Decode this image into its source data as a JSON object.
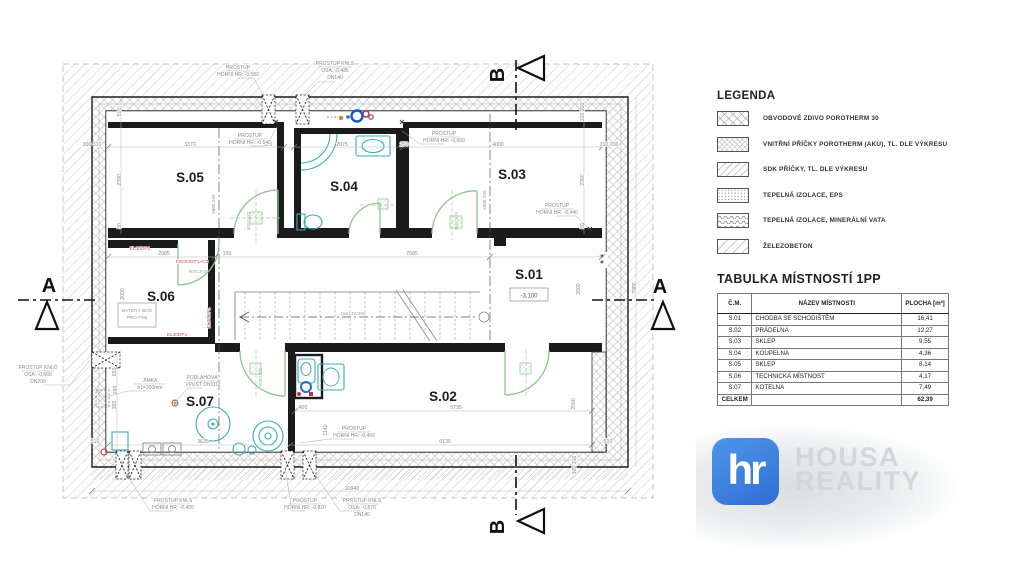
{
  "plan": {
    "section_a": "A",
    "section_b": "B",
    "level_tag": "-3,100",
    "stair_label": "18x172/300",
    "column_label": "HEB 240",
    "rooms": [
      {
        "label": "S.05"
      },
      {
        "label": "S.04"
      },
      {
        "label": "S.03"
      },
      {
        "label": "S.01"
      },
      {
        "label": "S.06"
      },
      {
        "label": "S.07"
      },
      {
        "label": "S.02"
      }
    ],
    "battery_box": {
      "l1": "BATERY BOX",
      "l2": "PRO FVE"
    },
    "red_notes": [
      "EL30DP1",
      "EW30/DP1+C3",
      "EL30DP1",
      "EL30DP1"
    ],
    "door_labels": [
      "800/1970",
      "800/1970",
      "900/1970",
      "800/1970"
    ],
    "annotations": [
      {
        "l1": "PROSTUP",
        "l2": "HORNÍ HR: -0,580"
      },
      {
        "l1": "PROSTUP KNLS",
        "l2": "OSA: -0,485",
        "l3": "DN140"
      },
      {
        "l1": "PROSTUP",
        "l2": "HORNÍ HR: -0,540"
      },
      {
        "l1": "PROSTUP",
        "l2": "HORNÍ HR: -0,500"
      },
      {
        "l1": "PROSTUP",
        "l2": "HORNÍ HR: -0,440"
      },
      {
        "l1": "PROSTUP KNLO",
        "l2": "OSA: -0,660",
        "l3": "DN200"
      },
      {
        "l1": "PROSTUP KNLS",
        "l2": "HORNÍ HR: -0,400"
      },
      {
        "l1": "PROSTUP",
        "l2": "HORNÍ HR: -0,820"
      },
      {
        "l1": "PROSTUP KNLS",
        "l2": "OSA: -0,870",
        "l3": "DN140"
      },
      {
        "l1": "PROSTUP",
        "l2": "HORNÍ HR: -0,450"
      },
      {
        "l1": "JÍMKA",
        "l2": "h1=300mm"
      },
      {
        "l1": "PODLAHOVÁ",
        "l2": "VPUSŤ DN110"
      }
    ],
    "dims": [
      "3370",
      "150",
      "2075",
      "4000",
      "310 200",
      "510",
      "2390",
      "50",
      "310 200",
      "2360",
      "50",
      "7685",
      "2085",
      "150",
      "2000",
      "2000",
      "7880",
      "3635",
      "400",
      "1140",
      "5735",
      "6135",
      "2060",
      "510",
      "300 310",
      "10940",
      "650",
      "290",
      "510",
      "300",
      "150",
      "300 310"
    ]
  },
  "legend": {
    "title": "LEGENDA",
    "items": [
      {
        "label": "OBVODOVÉ ZDIVO POROTHERM 30"
      },
      {
        "label": "VNITŘNÍ PŘÍČKY POROTHERM (AKU), TL. DLE VÝKRESU"
      },
      {
        "label": "SDK PŘÍČKY, TL. DLE VÝKRESU"
      },
      {
        "label": "TEPELNÁ IZOLACE, EPS"
      },
      {
        "label": "TEPELNÁ IZOLACE, MINERÁLNÍ VATA"
      },
      {
        "label": "ŽELEZOBETON"
      }
    ]
  },
  "room_table": {
    "title": "TABULKA MÍSTNOSTÍ 1PP",
    "headers": [
      "Č.M.",
      "NÁZEV MÍSTNOSTI",
      "PLOCHA [m²]"
    ],
    "rows": [
      [
        "S.01",
        "CHODBA SE SCHODIŠTĚM",
        "16,41"
      ],
      [
        "S.02",
        "PRÁDELNA",
        "12,27"
      ],
      [
        "S.03",
        "SKLEP",
        "9,55"
      ],
      [
        "S.04",
        "KOUPELNA",
        "4,36"
      ],
      [
        "S.05",
        "SKLEP",
        "8,14"
      ],
      [
        "S.06",
        "TECHNICKÁ MÍSTNOST",
        "4,17"
      ],
      [
        "S.07",
        "KOTELNA",
        "7,49"
      ]
    ],
    "total": {
      "label": "CELKEM",
      "value": "62,39"
    }
  },
  "logo": {
    "monogram": "hr",
    "name_line1": "HOUSA",
    "name_line2": "REALITY"
  }
}
